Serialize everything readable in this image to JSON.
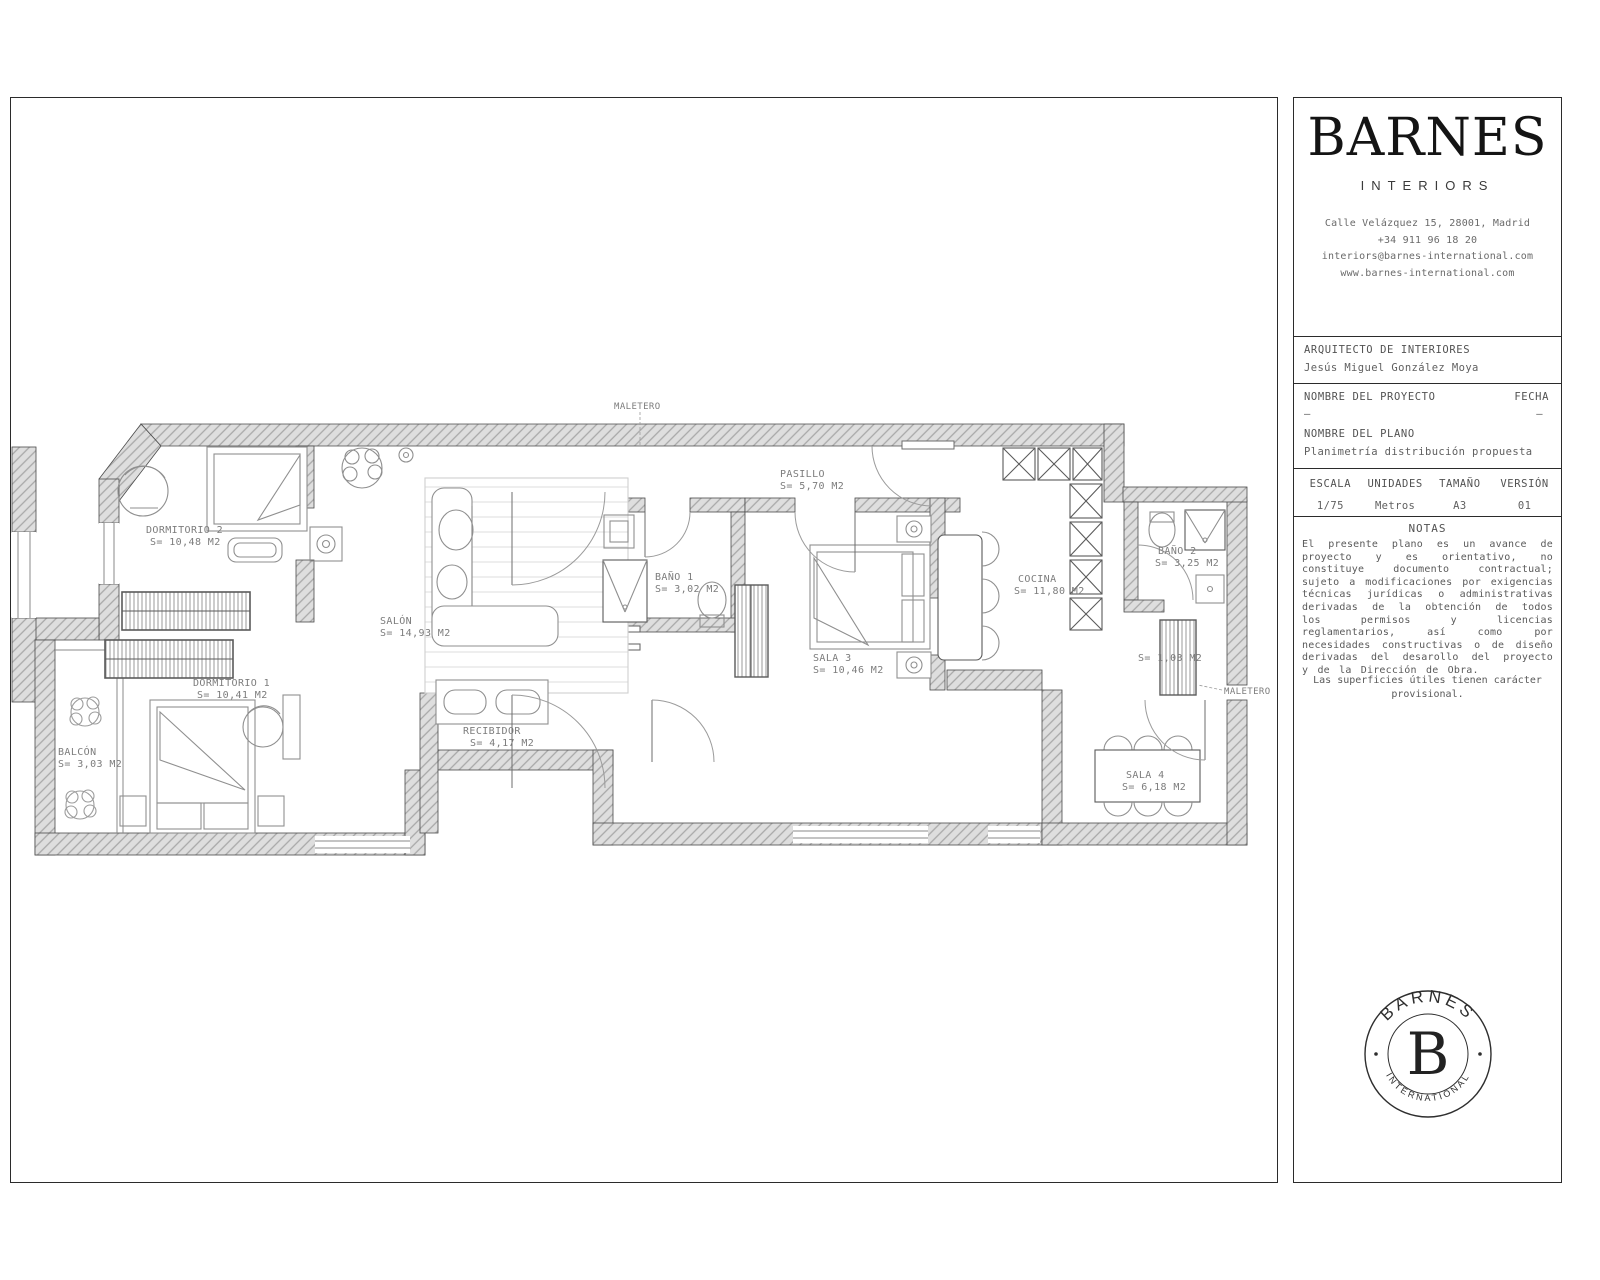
{
  "brand": {
    "logo": "BARNES",
    "sub": "INTERIORS",
    "address": "Calle Velázquez 15, 28001, Madrid",
    "phone": "+34 911 96 18 20",
    "email": "interiors@barnes-international.com",
    "web": "www.barnes-international.com"
  },
  "titleblock": {
    "architect_label": "ARQUITECTO DE INTERIORES",
    "architect_name": "Jesús Miguel González Moya",
    "project_label": "NOMBRE DEL PROYECTO",
    "project_value": "–",
    "date_label": "FECHA",
    "date_value": "–",
    "plan_label": "NOMBRE DEL PLANO",
    "plan_value": "Planimetría distribución propuesta",
    "scale_label": "ESCALA",
    "scale_value": "1/75",
    "units_label": "UNIDADES",
    "units_value": "Metros",
    "size_label": "TAMAÑO",
    "size_value": "A3",
    "version_label": "VERSIÓN",
    "version_value": "01",
    "notes_title": "NOTAS",
    "notes_body": "El presente plano es un avance de proyecto y es orientativo, no constituye documento contractual; sujeto a modificaciones por exigencias técnicas jurídicas o administrativas derivadas de la obtención de todos los permisos y licencias reglamentarios, así como por necesidades constructivas o de diseño derivadas del desarollo del proyecto y de la Dirección de Obra.",
    "notes_footer": "Las superficies útiles tienen carácter provisional."
  },
  "seal": {
    "top": "BARNES",
    "center": "B",
    "bottom": "INTERNATIONAL"
  },
  "plan": {
    "rooms": [
      {
        "name": "DORMITORIO 2",
        "area": "S= 10,48 M2"
      },
      {
        "name": "DORMITORIO 1",
        "area": "S= 10,41 M2"
      },
      {
        "name": "BALCÓN",
        "area": "S= 3,03 M2"
      },
      {
        "name": "SALÓN",
        "area": "S= 14,93 M2"
      },
      {
        "name": "RECIBIDOR",
        "area": "S= 4,17 M2"
      },
      {
        "name": "BAÑO 1",
        "area": "S= 3,02 M2"
      },
      {
        "name": "PASILLO",
        "area": "S= 5,70 M2"
      },
      {
        "name": "SALA 3",
        "area": "S= 10,46 M2"
      },
      {
        "name": "COCINA",
        "area": "S= 11,80 M2"
      },
      {
        "name": "BAÑO 2",
        "area": "S= 3,25 M2"
      },
      {
        "name": "SALA 4",
        "area": "S= 6,18 M2"
      }
    ],
    "extra_labels": [
      {
        "text": "MALETERO"
      },
      {
        "text": "MALETERO"
      },
      {
        "text": "S= 1,03 M2"
      }
    ],
    "colors": {
      "wall_fill": "#dedede",
      "wall_line": "#a8a8a8",
      "outline": "#4a4a4a",
      "furniture": "#8f8f8f",
      "label": "#7c7c7c"
    }
  }
}
